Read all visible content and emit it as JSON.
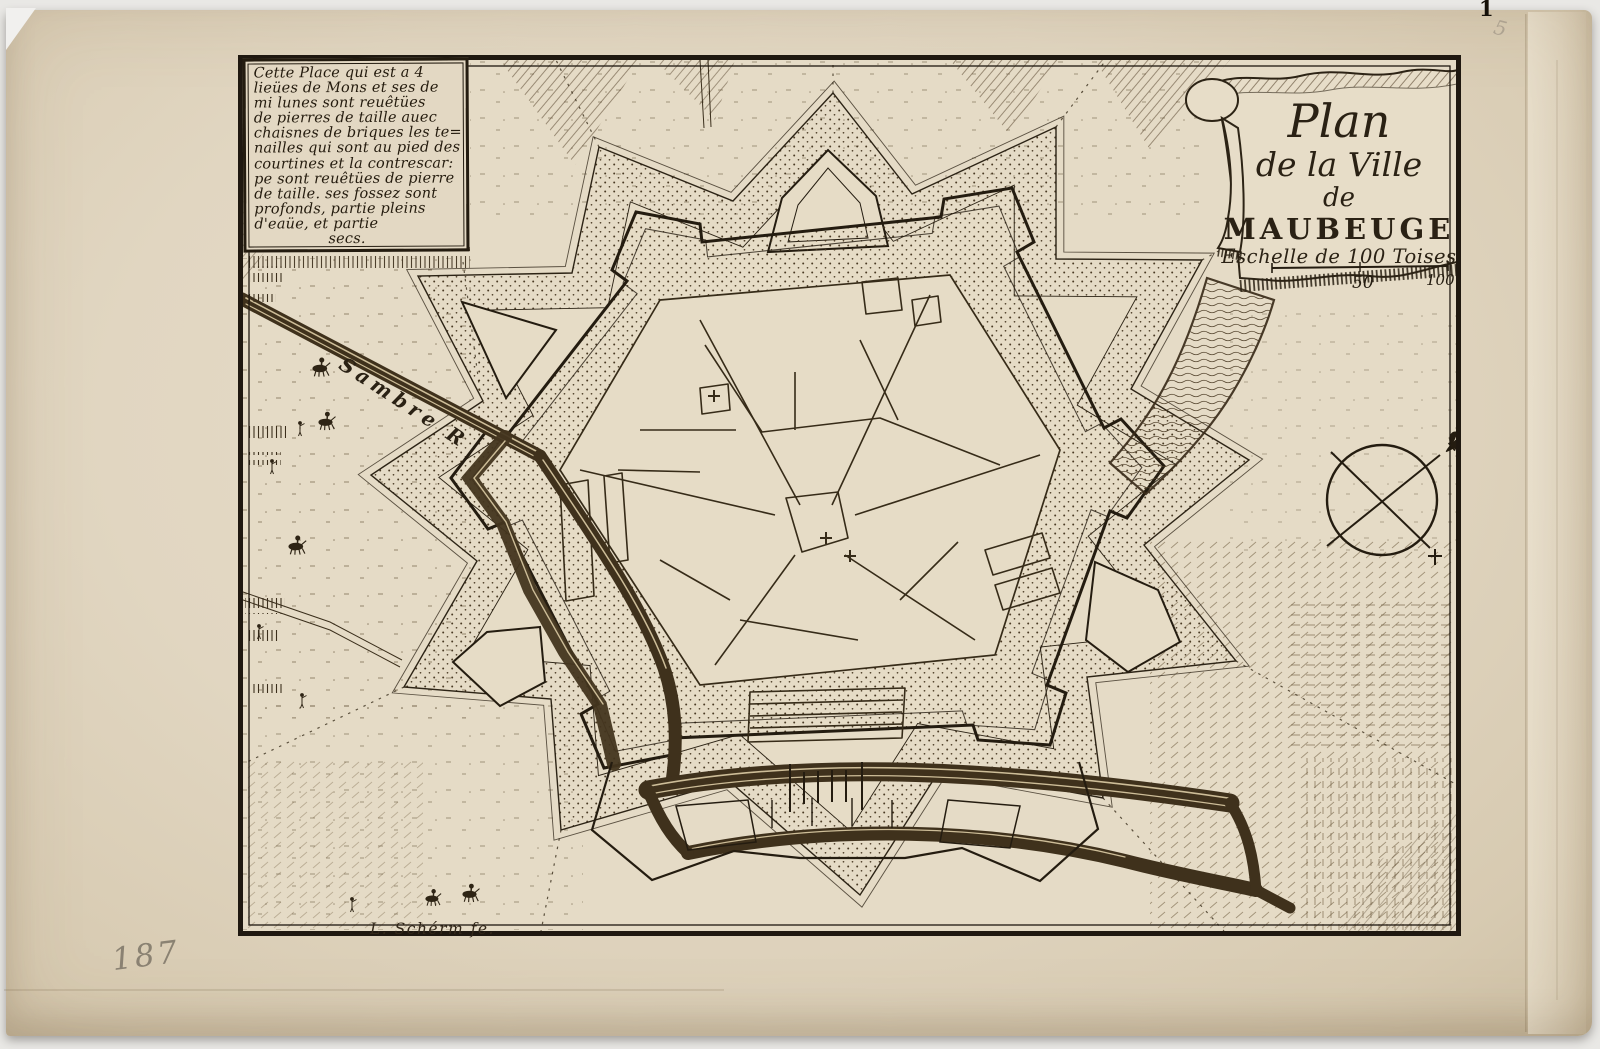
{
  "plate": {
    "number": "1",
    "pencil_inventory_number": "187",
    "pencil_corner_mark": "5"
  },
  "description_cartouche": {
    "lines": [
      "Cette Place qui est a 4",
      "lieües de Mons et ses de",
      "mi lunes sont reuêtües",
      "de pierres de taille auec",
      "chaisnes de briques les te=",
      "nailles qui sont au pied des",
      "courtines et la contrescar:",
      "pe sont reuêtües de pierre",
      "de taille. ses fossez sont",
      "profonds, partie pleins",
      "d'eaüe, et partie",
      "secs."
    ]
  },
  "title_cartouche": {
    "title_line_1": "Plan",
    "title_line_2": "de la Ville",
    "title_line_3": "de",
    "city_name": "MAUBEUGE",
    "scale_label": "Eschelle de 100 Toises",
    "scale_tick_left": "50",
    "scale_tick_right": "100"
  },
  "map": {
    "river_label": "Sambre R",
    "engraver_signature": "L. Schérm fe."
  },
  "colors": {
    "paper": "#ded2bb",
    "ink": "#2a2114",
    "pencil": "#7d7567",
    "backdrop": "#efeeec"
  }
}
